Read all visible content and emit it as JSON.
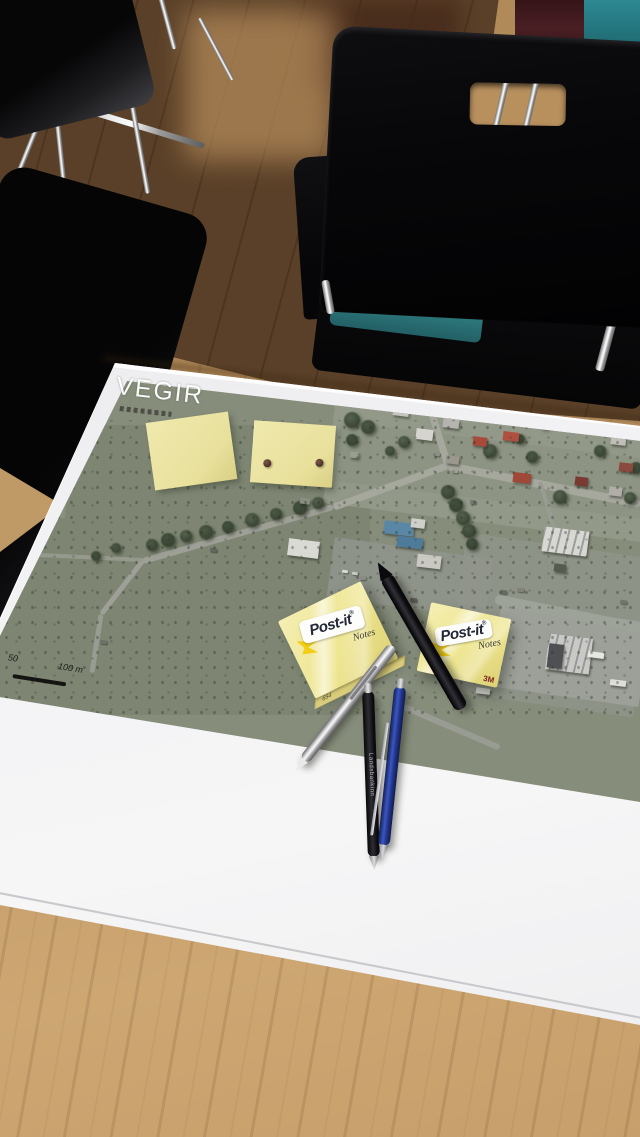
{
  "map": {
    "title": "VEGIR",
    "scale_50": "50",
    "scale_100": "100 m"
  },
  "postit": {
    "brand": "Post-it",
    "reg": "®",
    "notes": "Notes",
    "threem": "3M",
    "side_label": "654"
  },
  "pens": {
    "black_pen_text": "Landsbankinn"
  },
  "colors": {
    "map_base": "#868d7b",
    "postit_yellow": "#ece5a8",
    "table_wood": "#c49d6b",
    "floor_dark": "#543c24",
    "seat_teal": "#35888c",
    "corner_maroon": "#4a1f24",
    "pen_blue": "#24368c",
    "paper_white": "#f2f2f4"
  },
  "map_features": {
    "patches": [
      {
        "x": 0,
        "y": 425,
        "w": 370,
        "h": 290,
        "r": 0,
        "c": "#7e8673",
        "o": 1
      },
      {
        "x": 330,
        "y": 388,
        "w": 320,
        "h": 135,
        "r": 7,
        "c": "#939a8b",
        "o": 0.9
      },
      {
        "x": 336,
        "y": 440,
        "w": 310,
        "h": 60,
        "r": 7,
        "c": "#8b9280",
        "o": 0.7
      },
      {
        "x": 455,
        "y": 545,
        "w": 190,
        "h": 160,
        "r": 8,
        "c": "#8f948a",
        "o": 0.9
      },
      {
        "x": 330,
        "y": 548,
        "w": 160,
        "h": 60,
        "r": 8,
        "c": "#90958c",
        "o": 0.9
      },
      {
        "x": 495,
        "y": 612,
        "w": 150,
        "h": 85,
        "r": 8,
        "c": "#9da099",
        "o": 0.95
      },
      {
        "x": 58,
        "y": 430,
        "w": 10,
        "h": 88,
        "r": 4,
        "c": "#8c9180",
        "o": 0.9
      }
    ],
    "roads": [
      {
        "x1": 448,
        "y1": 462,
        "x2": 640,
        "y2": 500,
        "w": 8,
        "c": "#a6a89e"
      },
      {
        "x1": 448,
        "y1": 462,
        "x2": 333,
        "y2": 504,
        "w": 7,
        "c": "#a6a89e"
      },
      {
        "x1": 333,
        "y1": 504,
        "x2": 143,
        "y2": 558,
        "w": 6,
        "c": "#9ea097"
      },
      {
        "x1": 143,
        "y1": 558,
        "x2": 101,
        "y2": 612,
        "w": 5,
        "c": "#9ea097"
      },
      {
        "x1": 101,
        "y1": 612,
        "x2": 92,
        "y2": 670,
        "w": 5,
        "c": "#999c92"
      },
      {
        "x1": 448,
        "y1": 462,
        "x2": 428,
        "y2": 398,
        "w": 7,
        "c": "#a6a89e"
      },
      {
        "x1": 0,
        "y1": 551,
        "x2": 143,
        "y2": 558,
        "w": 4,
        "c": "#969a8e"
      },
      {
        "x1": 495,
        "y1": 594,
        "x2": 640,
        "y2": 623,
        "w": 10,
        "c": "#9ea39a"
      },
      {
        "x1": 540,
        "y1": 480,
        "x2": 560,
        "y2": 545,
        "w": 4,
        "c": "#999c92"
      },
      {
        "x1": 395,
        "y1": 700,
        "x2": 500,
        "y2": 745,
        "w": 6,
        "c": "#999c92"
      }
    ],
    "buildings": [
      {
        "x": 393,
        "y": 406,
        "w": 16,
        "h": 10,
        "c": "#c6c4be"
      },
      {
        "x": 416,
        "y": 429,
        "w": 17,
        "h": 11,
        "c": "#d6d4ce"
      },
      {
        "x": 443,
        "y": 419,
        "w": 16,
        "h": 9,
        "c": "#b6b4ae"
      },
      {
        "x": 473,
        "y": 437,
        "w": 14,
        "h": 9,
        "c": "#a84a3a"
      },
      {
        "x": 503,
        "y": 432,
        "w": 16,
        "h": 9,
        "c": "#b05040"
      },
      {
        "x": 446,
        "y": 456,
        "w": 13,
        "h": 8,
        "c": "#9a988f"
      },
      {
        "x": 513,
        "y": 473,
        "w": 18,
        "h": 10,
        "c": "#a04838"
      },
      {
        "x": 575,
        "y": 477,
        "w": 13,
        "h": 9,
        "c": "#7a3a34"
      },
      {
        "x": 611,
        "y": 435,
        "w": 15,
        "h": 10,
        "c": "#c0beb6"
      },
      {
        "x": 619,
        "y": 463,
        "w": 14,
        "h": 9,
        "c": "#8a4a3e"
      },
      {
        "x": 609,
        "y": 487,
        "w": 13,
        "h": 9,
        "c": "#b0aea6"
      },
      {
        "x": 384,
        "y": 522,
        "w": 30,
        "h": 13,
        "c": "#5b87a6"
      },
      {
        "x": 397,
        "y": 537,
        "w": 26,
        "h": 11,
        "c": "#4f7b9a"
      },
      {
        "x": 411,
        "y": 519,
        "w": 14,
        "h": 9,
        "c": "#d0d0ca"
      },
      {
        "x": 543,
        "y": 529,
        "w": 45,
        "h": 25,
        "c": "#d8d8d2",
        "s": 1
      },
      {
        "x": 547,
        "y": 636,
        "w": 44,
        "h": 36,
        "c": "#c9c9c5",
        "s": 1
      },
      {
        "x": 548,
        "y": 644,
        "w": 15,
        "h": 24,
        "c": "#4e5054"
      },
      {
        "x": 288,
        "y": 540,
        "w": 31,
        "h": 17,
        "c": "#dadad4"
      },
      {
        "x": 417,
        "y": 555,
        "w": 24,
        "h": 13,
        "c": "#cac8c2"
      },
      {
        "x": 18,
        "y": 485,
        "w": 12,
        "h": 7,
        "c": "#6a6a60"
      },
      {
        "x": 40,
        "y": 471,
        "w": 12,
        "h": 7,
        "c": "#74746a"
      },
      {
        "x": 64,
        "y": 439,
        "w": 14,
        "h": 8,
        "c": "#7e7e76"
      },
      {
        "x": 68,
        "y": 457,
        "w": 12,
        "h": 7,
        "c": "#6e6e64"
      },
      {
        "x": 554,
        "y": 564,
        "w": 12,
        "h": 8,
        "c": "#565a50"
      },
      {
        "x": 588,
        "y": 652,
        "w": 16,
        "h": 6,
        "c": "#e6e6e2"
      },
      {
        "x": 610,
        "y": 680,
        "w": 16,
        "h": 6,
        "c": "#dededa"
      },
      {
        "x": 476,
        "y": 688,
        "w": 14,
        "h": 6,
        "c": "#d6d6d2"
      },
      {
        "x": 300,
        "y": 498,
        "w": 10,
        "h": 6,
        "c": "#8a8e82"
      },
      {
        "x": 350,
        "y": 452,
        "w": 9,
        "h": 6,
        "c": "#9a9e92"
      }
    ],
    "cars": [
      {
        "x": 434,
        "y": 452,
        "w": 6,
        "h": 4,
        "c": "#909088"
      },
      {
        "x": 452,
        "y": 469,
        "w": 6,
        "h": 4,
        "c": "#a0a098"
      },
      {
        "x": 470,
        "y": 500,
        "w": 6,
        "h": 4,
        "c": "#787870"
      },
      {
        "x": 500,
        "y": 590,
        "w": 7,
        "h": 4,
        "c": "#6a6a62"
      },
      {
        "x": 517,
        "y": 588,
        "w": 7,
        "h": 4,
        "c": "#82827a"
      },
      {
        "x": 410,
        "y": 598,
        "w": 7,
        "h": 4,
        "c": "#5e5e56"
      },
      {
        "x": 360,
        "y": 576,
        "w": 6,
        "h": 4,
        "c": "#8e8e86"
      },
      {
        "x": 342,
        "y": 570,
        "w": 6,
        "h": 3,
        "c": "#d8d8d2"
      },
      {
        "x": 352,
        "y": 572,
        "w": 6,
        "h": 3,
        "c": "#c8c8c2"
      },
      {
        "x": 384,
        "y": 580,
        "w": 6,
        "h": 3,
        "c": "#b8b8b2"
      },
      {
        "x": 620,
        "y": 600,
        "w": 7,
        "h": 4,
        "c": "#74746c"
      },
      {
        "x": 210,
        "y": 548,
        "w": 7,
        "h": 4,
        "c": "#62665c"
      },
      {
        "x": 100,
        "y": 640,
        "w": 7,
        "h": 4,
        "c": "#6e7268"
      }
    ],
    "trees": [
      {
        "x": 152,
        "y": 545,
        "r": 6
      },
      {
        "x": 168,
        "y": 540,
        "r": 7
      },
      {
        "x": 186,
        "y": 536,
        "r": 6
      },
      {
        "x": 206,
        "y": 532,
        "r": 7
      },
      {
        "x": 228,
        "y": 527,
        "r": 6
      },
      {
        "x": 252,
        "y": 520,
        "r": 7
      },
      {
        "x": 276,
        "y": 514,
        "r": 6
      },
      {
        "x": 300,
        "y": 508,
        "r": 7
      },
      {
        "x": 318,
        "y": 503,
        "r": 6
      },
      {
        "x": 448,
        "y": 492,
        "r": 7
      },
      {
        "x": 456,
        "y": 505,
        "r": 7
      },
      {
        "x": 463,
        "y": 518,
        "r": 7
      },
      {
        "x": 469,
        "y": 531,
        "r": 7
      },
      {
        "x": 472,
        "y": 544,
        "r": 6
      },
      {
        "x": 352,
        "y": 420,
        "r": 8
      },
      {
        "x": 368,
        "y": 427,
        "r": 7
      },
      {
        "x": 450,
        "y": 413,
        "r": 6
      },
      {
        "x": 490,
        "y": 451,
        "r": 7
      },
      {
        "x": 532,
        "y": 457,
        "r": 6
      },
      {
        "x": 352,
        "y": 440,
        "r": 6
      },
      {
        "x": 560,
        "y": 497,
        "r": 7
      },
      {
        "x": 600,
        "y": 451,
        "r": 6
      },
      {
        "x": 628,
        "y": 427,
        "r": 7
      },
      {
        "x": 582,
        "y": 419,
        "r": 6
      },
      {
        "x": 545,
        "y": 423,
        "r": 6
      },
      {
        "x": 520,
        "y": 439,
        "r": 5
      },
      {
        "x": 404,
        "y": 442,
        "r": 6
      },
      {
        "x": 390,
        "y": 451,
        "r": 5
      },
      {
        "x": 636,
        "y": 468,
        "r": 6
      },
      {
        "x": 630,
        "y": 498,
        "r": 6
      },
      {
        "x": 116,
        "y": 548,
        "r": 5
      },
      {
        "x": 96,
        "y": 556,
        "r": 5
      }
    ]
  }
}
